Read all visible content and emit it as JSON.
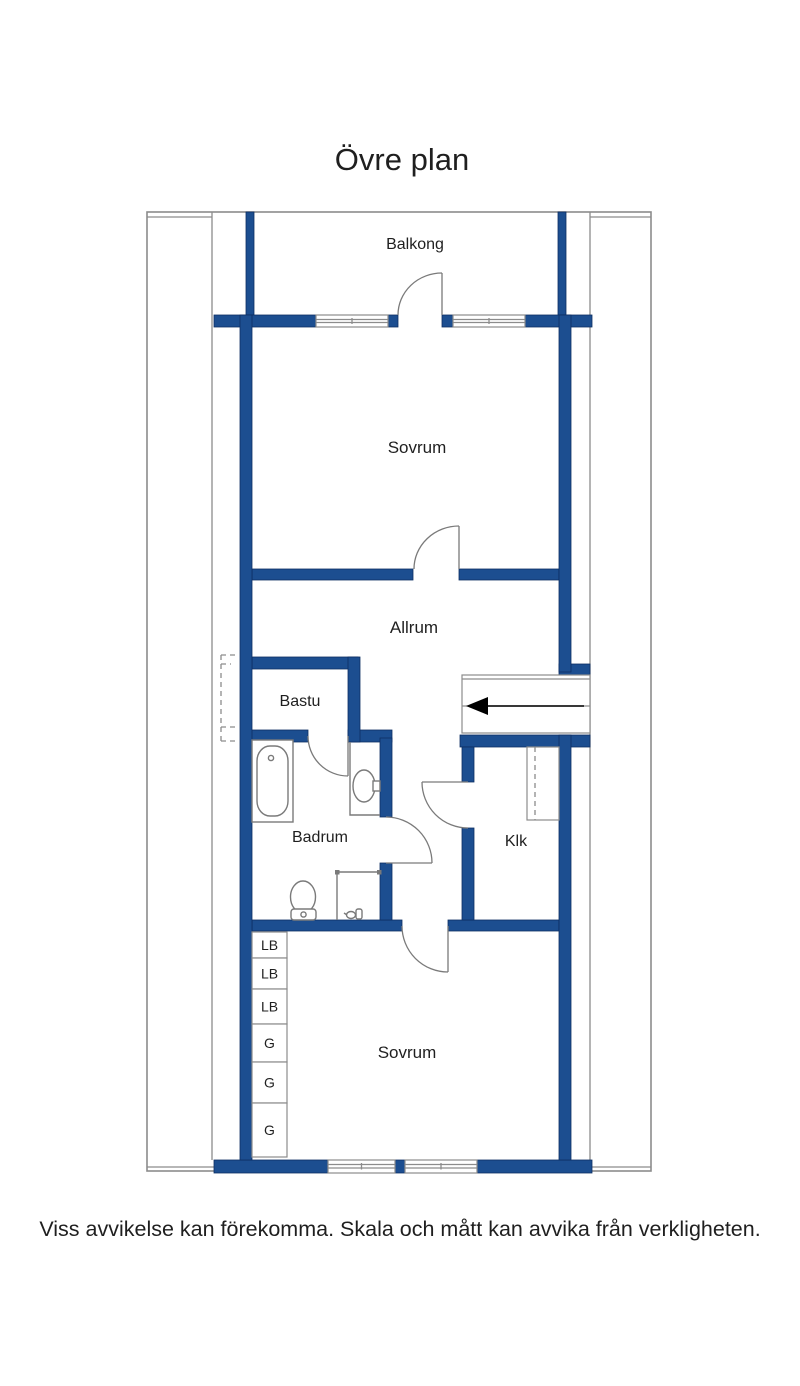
{
  "title": "Övre plan",
  "disclaimer": "Viss avvikelse kan förekomma. Skala och mått kan avvika från verkligheten.",
  "rooms": {
    "balkong": "Balkong",
    "sovrum_top": "Sovrum",
    "allrum": "Allrum",
    "bastu": "Bastu",
    "badrum": "Badrum",
    "klk": "Klk",
    "sovrum_bottom": "Sovrum"
  },
  "closets": {
    "cells": [
      "LB",
      "LB",
      "LB",
      "G",
      "G",
      "G"
    ]
  },
  "icons": {
    "stairs_direction": "arrow-left",
    "fixtures": [
      "bathtub",
      "washbasin",
      "toilet",
      "shower-head",
      "wardrobe",
      "staircase"
    ]
  },
  "colors": {
    "wall": "#1c4e90",
    "wall-edge": "#0d2f63",
    "line": "#8c8c8c",
    "fixture": "#7a7a7a",
    "text": "#1f1f1f",
    "arrow": "#000000"
  }
}
